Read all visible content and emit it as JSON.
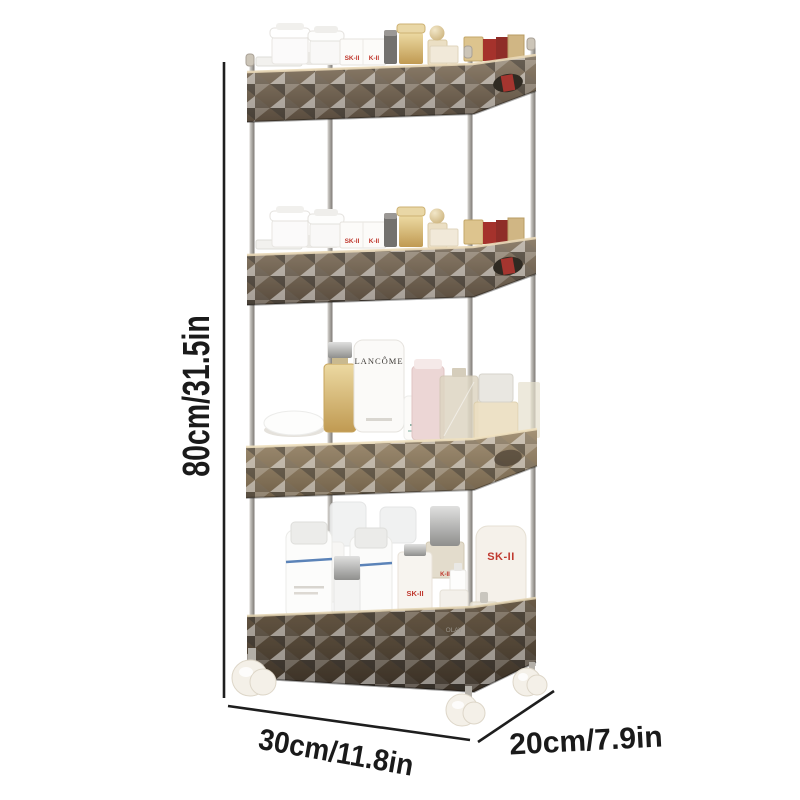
{
  "scene": {
    "description": "Four-tier diamond-textured rolling storage cart filled with cosmetics, annotated with product dimensions",
    "tier_count": 4,
    "wheel_count": 3
  },
  "dimensions": {
    "height": "80cm/31.5in",
    "width": "30cm/11.8in",
    "depth": "20cm/7.9in"
  },
  "brand_marks": {
    "tier1_box_left": "SK-II",
    "tier1_box_right": "K-II",
    "tier2_box_left": "SK-II",
    "tier2_box_right": "K-II",
    "tier3_tube": "LANCÔME",
    "tier4_mid_bottle": "K-II",
    "tier4_bottle": "SK-II",
    "tier4_tube": "SK-II",
    "tier4_jar": "OLAY"
  },
  "colors": {
    "background": "#ffffff",
    "annotation_text": "#1a1a1a",
    "annotation_line": "#1e1e1e",
    "basket_bronze": "#8a7866",
    "basket_light": "#c9b493",
    "basket_dark": "#5c4f41",
    "pole_silver": "#b5b2ac",
    "wheel_white": "#f3efe7",
    "red_box": "#a5322c",
    "brand_red": "#c0392f"
  }
}
